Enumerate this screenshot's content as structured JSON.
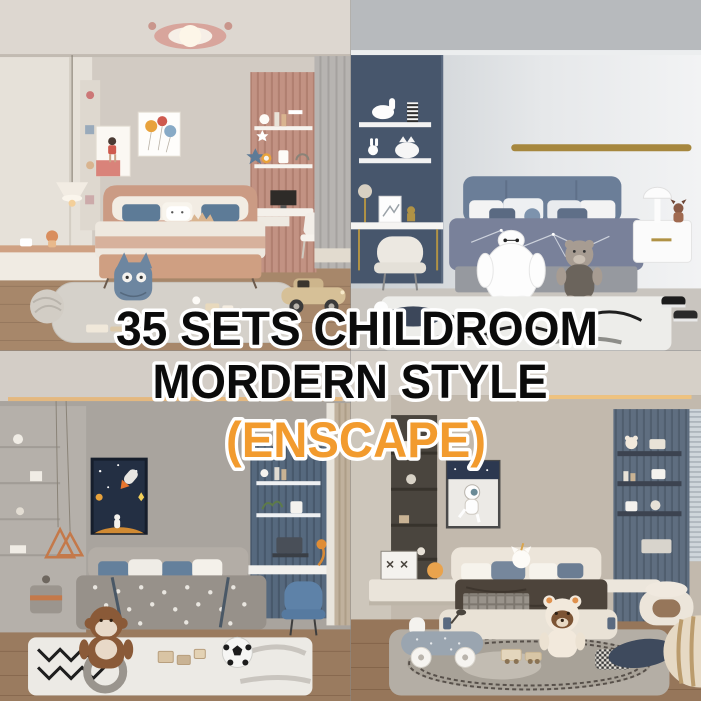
{
  "overlay": {
    "line1": "35 SETS CHILDROOM",
    "line2": "MORDERN STYLE",
    "line3": "(ENSCAPE)",
    "text_color": "#0b0b0b",
    "accent_text_color": "#f29b2e",
    "outline_color": "#ffffff"
  },
  "collage": {
    "layout": "2x2",
    "scenes": [
      {
        "position": "top-left",
        "label": "pink child bedroom render",
        "accent_color": "#c29283"
      },
      {
        "position": "top-right",
        "label": "navy child bedroom render",
        "accent_color": "#47566c"
      },
      {
        "position": "bottom-left",
        "label": "grey space-theme child bedroom render",
        "accent_color": "#56697e"
      },
      {
        "position": "bottom-right",
        "label": "beige child bedroom render",
        "accent_color": "#5f6e80"
      }
    ]
  }
}
